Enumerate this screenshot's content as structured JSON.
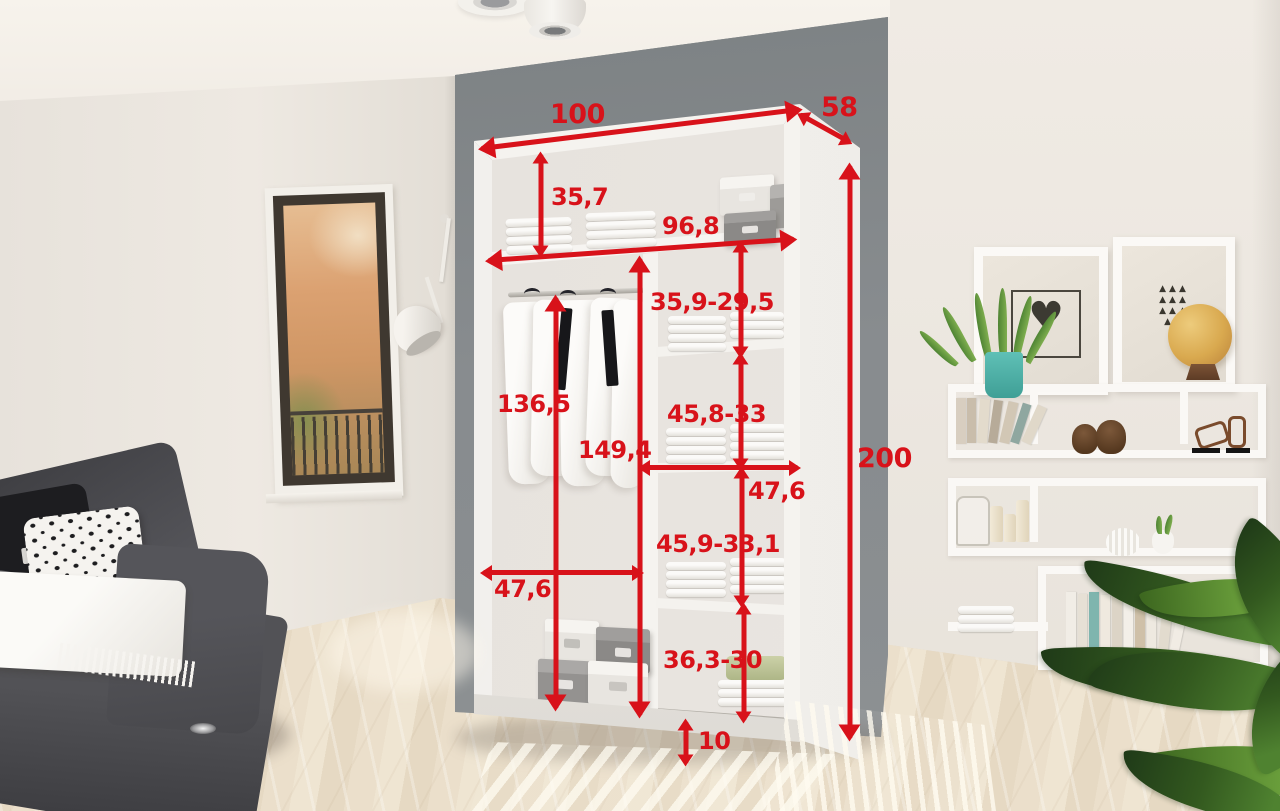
{
  "colors": {
    "annotation_red": "#d8121a",
    "partition_panel_gray": "#868b8d",
    "wardrobe_white": "#f5f3f0",
    "wall_cream": "#ece7e0",
    "floor_wood": "#e8dcc7",
    "sofa_gray": "#4c4c50",
    "plant_pot_teal": "#53b8b0",
    "globe_yellow": "#dcaf5e"
  },
  "wardrobe": {
    "measurements": {
      "total_width": "100",
      "depth": "58",
      "total_height": "200",
      "top_compartment_height": "35,7",
      "inner_width": "96,8",
      "shelf_gap_1": "35,9-29,5",
      "hanging_section_height": "136,5",
      "inner_height": "149,4",
      "shelf_gap_2": "45,8-33",
      "right_section_width": "47,6",
      "shelf_gap_3": "45,9-33,1",
      "left_section_width": "47,6",
      "shelf_gap_4": "36,3-30",
      "plinth_height": "10"
    }
  },
  "artwork": {
    "heart_glyph": "♥",
    "triangle_row_1": "▲▲▲",
    "triangle_row_2": "▲▲▲",
    "triangle_row_3": "▲▲▲",
    "triangle_row_4": "▲▲"
  }
}
